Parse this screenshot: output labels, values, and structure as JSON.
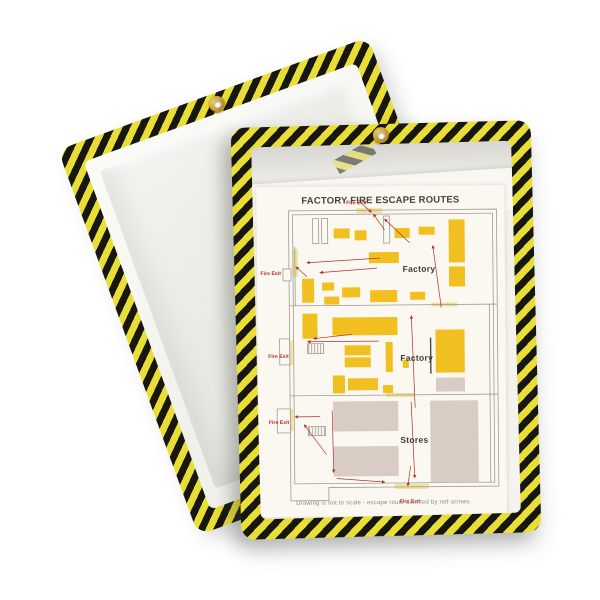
{
  "product": {
    "description": "Two shop ticket holders with yellow-black hazard striped frames and brass hanging grommets; rear holder empty and tilted, front holder displaying a fire escape route sheet",
    "back_holder": "empty hazard-stripe ticket holder",
    "front_holder": "hazard-stripe ticket holder with document"
  },
  "colors": {
    "stripe_yellow": "#e8de35",
    "stripe_black": "#17160f",
    "map_yellow": "#f2bf20",
    "map_tan": "#d9ccc4",
    "exit_red": "#b23327",
    "wall_gray": "#a09b90",
    "pale_exit": "#f1e0a0",
    "paper": "#faf8f1"
  },
  "document": {
    "title": "FACTORY FIRE ESCAPE ROUTES",
    "caption": "Drawing is not to scale - escape route denoted by red arrows",
    "plan": {
      "offset": [
        32,
        24
      ],
      "wall_paths": [
        "M0,0 H208 V277 H38 V290 H0 Z",
        "M4,4 H204 V273 H4 Z",
        "M0,95 H208",
        "M0,185 H208",
        "M200,95 V273",
        "M6,36 V95"
      ],
      "bar_paths": [
        "M141,128 V164"
      ],
      "exit_strips": [
        [
          68,
          -2,
          26,
          5
        ],
        [
          4,
          38,
          5,
          28
        ],
        [
          -2,
          130,
          5,
          24
        ],
        [
          -2,
          198,
          5,
          22
        ],
        [
          104,
          274,
          34,
          5
        ],
        [
          96,
          183,
          28,
          4
        ],
        [
          142,
          93,
          26,
          4
        ]
      ],
      "yellow_blocks": [
        [
          45,
          18,
          16,
          10
        ],
        [
          66,
          20,
          12,
          10
        ],
        [
          106,
          18,
          15,
          10
        ],
        [
          130,
          17,
          16,
          8
        ],
        [
          80,
          42,
          30,
          11
        ],
        [
          160,
          10,
          16,
          43
        ],
        [
          160,
          57,
          16,
          20
        ],
        [
          13,
          68,
          12,
          24
        ],
        [
          33,
          72,
          12,
          8
        ],
        [
          35,
          86,
          15,
          8
        ],
        [
          53,
          77,
          18,
          10
        ],
        [
          81,
          80,
          27,
          12
        ],
        [
          121,
          82,
          15,
          8
        ],
        [
          13,
          103,
          15,
          25
        ],
        [
          43,
          107,
          65,
          18
        ],
        [
          55,
          135,
          26,
          10
        ],
        [
          55,
          147,
          26,
          10
        ],
        [
          96,
          132,
          7,
          30
        ],
        [
          113,
          150,
          6,
          8
        ],
        [
          43,
          165,
          12,
          18
        ],
        [
          58,
          168,
          30,
          12
        ],
        [
          93,
          175,
          10,
          8
        ],
        [
          146,
          120,
          29,
          43
        ]
      ],
      "tan_blocks": [
        [
          146,
          168,
          29,
          14
        ],
        [
          43,
          191,
          65,
          30
        ],
        [
          43,
          236,
          65,
          30
        ],
        [
          140,
          191,
          48,
          82
        ]
      ],
      "slots": [
        [
          24,
          8,
          6,
          25
        ],
        [
          33,
          8,
          6,
          25
        ],
        [
          95,
          6,
          6,
          27
        ]
      ],
      "bumpouts": [
        [
          -6,
          58,
          8,
          12
        ],
        [
          -10,
          128,
          10,
          26
        ],
        [
          -13,
          198,
          13,
          24
        ]
      ],
      "stairs": [
        [
          18,
          133,
          16,
          10
        ],
        [
          18,
          216,
          17,
          9
        ]
      ],
      "arrows": [
        [
          96,
          20,
          85,
          4
        ],
        [
          121,
          33,
          96,
          9
        ],
        [
          91,
          48,
          18,
          52
        ],
        [
          88,
          58,
          31,
          62
        ],
        [
          18,
          66,
          7,
          56
        ],
        [
          152,
          98,
          144,
          36
        ],
        [
          89,
          131,
          18,
          131
        ],
        [
          62,
          124,
          24,
          128
        ],
        [
          125,
          198,
          122,
          106
        ],
        [
          42,
          200,
          43,
          262
        ],
        [
          30,
          206,
          5,
          206
        ],
        [
          36,
          244,
          14,
          214
        ],
        [
          121,
          192,
          124,
          268
        ],
        [
          46,
          268,
          94,
          272
        ],
        [
          120,
          256,
          117,
          276
        ],
        [
          74,
          -6,
          83,
          2
        ]
      ],
      "area_labels": [
        {
          "text": "Factory",
          "x": 130,
          "y": 62
        },
        {
          "text": "Factory",
          "x": 127,
          "y": 151
        },
        {
          "text": "Stores",
          "x": 124,
          "y": 233
        }
      ],
      "exit_labels": [
        {
          "text": "Fire Exit",
          "x": 68,
          "y": -6,
          "anchor": "middle"
        },
        {
          "text": "Fire Exit",
          "x": -8,
          "y": 64,
          "anchor": "end"
        },
        {
          "text": "Fire Exit",
          "x": -1,
          "y": 147,
          "anchor": "end"
        },
        {
          "text": "Fire Exit",
          "x": -1,
          "y": 213,
          "anchor": "end"
        },
        {
          "text": "Fire Exit",
          "x": 119,
          "y": 293,
          "anchor": "middle"
        }
      ]
    }
  }
}
